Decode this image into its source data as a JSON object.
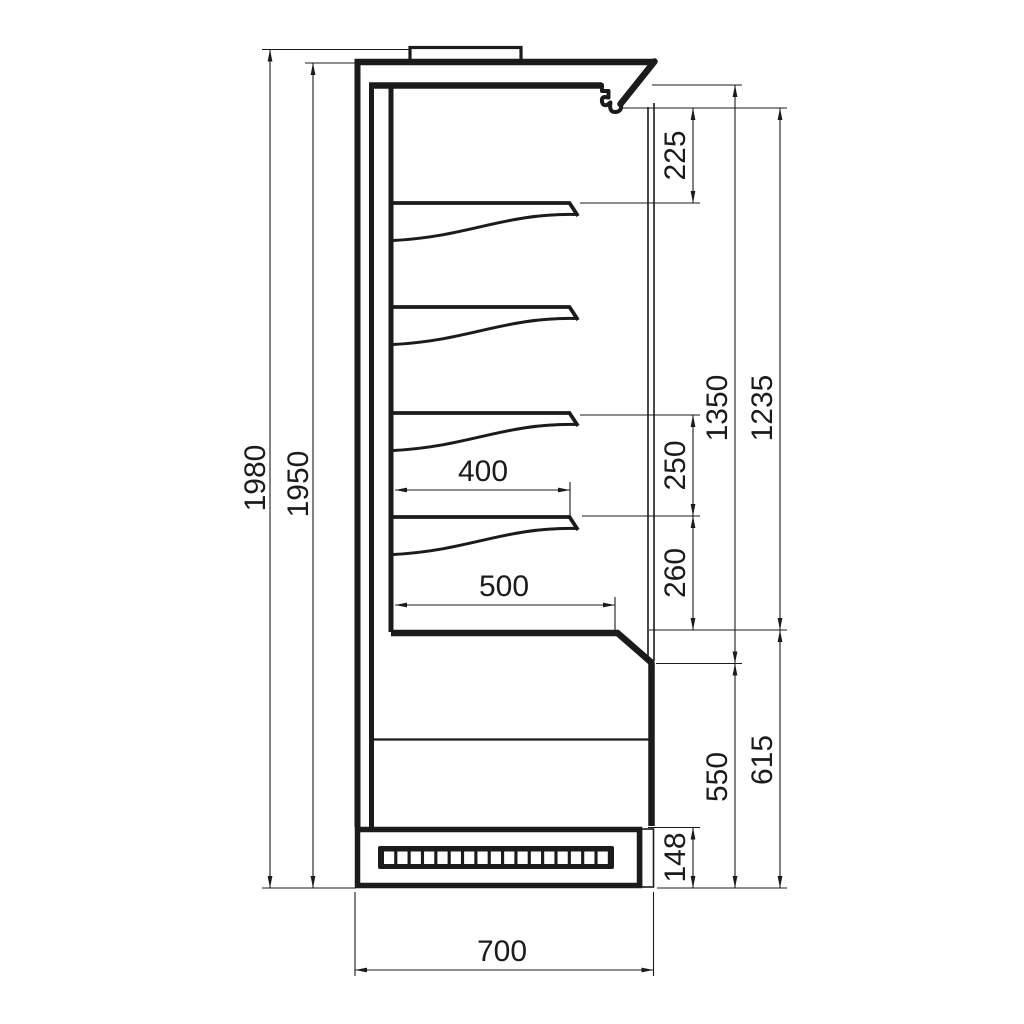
{
  "dimensions": {
    "overall_height": "1980",
    "body_height": "1950",
    "canopy_to_first_shelf": "225",
    "interior_height": "1350",
    "opening_height": "1235",
    "shelf_spacing": "250",
    "last_shelf_to_deck": "260",
    "shelf_depth": "400",
    "deck_depth": "500",
    "front_height": "550",
    "deck_height": "615",
    "plinth_height": "148",
    "overall_depth": "700"
  }
}
